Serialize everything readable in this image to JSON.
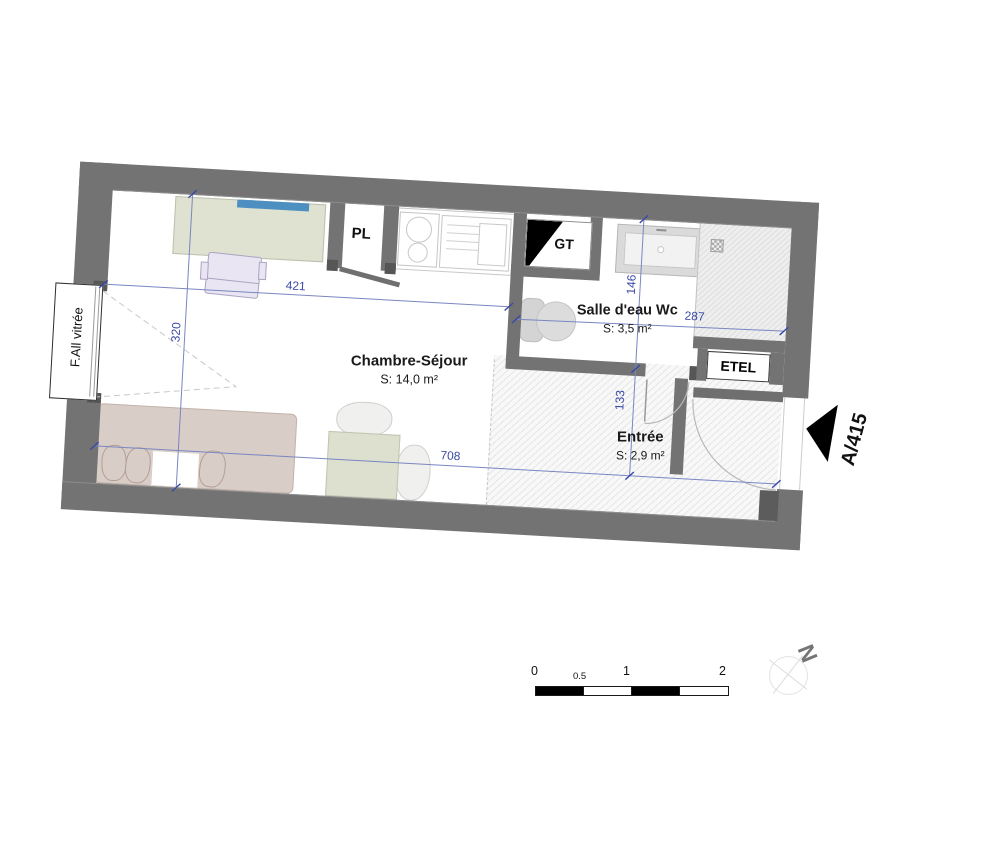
{
  "plan": {
    "rooms": [
      {
        "name": "Chambre-Séjour",
        "area": "S: 14,0 m²"
      },
      {
        "name": "Salle d'eau Wc",
        "area": "S: 3,5 m²"
      },
      {
        "name": "Entrée",
        "area": "S: 2,9 m²"
      }
    ],
    "fixtures": {
      "closet": "PL",
      "duct": "GT",
      "electrical_niche": "ETEL",
      "window": "F.All vitrée"
    },
    "door_marker": "A/415",
    "dimensions": {
      "chambre_width": "421",
      "chambre_depth": "320",
      "bath_depth": "146",
      "bath_width": "287",
      "entree_depth": "133",
      "total_width": "708"
    },
    "colors": {
      "wall": "#737373",
      "dimension_blue": "#3a4aa5",
      "desk_green": "#dfe2d0",
      "shelf_blue": "#4d8fc0",
      "bed_tan": "#d8cdc7",
      "chair_lilac": "#e9e5f2"
    }
  },
  "scale_bar": {
    "labels": [
      "0",
      "0.5",
      "1",
      "2"
    ]
  },
  "compass": {
    "north_label": "N"
  }
}
